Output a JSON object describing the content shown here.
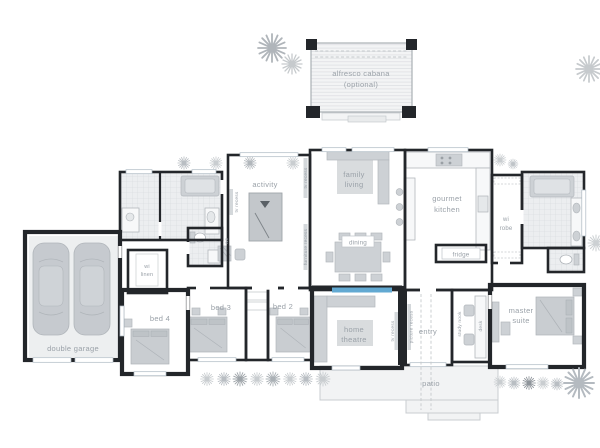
{
  "page": {
    "title": "house floor plan"
  },
  "colors": {
    "wall": "#23262a",
    "tile_floor": "#eceef0",
    "furniture_grey": "#cdd1d5",
    "rug_grey": "#d9dcde",
    "screen_blue": "#62a9d2",
    "label_text": "#9aa1a8",
    "patio_grey": "#f2f3f4",
    "tree_light": "#c6cacd",
    "tree_dark": "#a6abb0"
  },
  "rooms": {
    "alfresco": {
      "line1": "alfresco cabana",
      "line2": "(optional)"
    },
    "family": {
      "line1": "family",
      "line2": "living"
    },
    "kitchen": {
      "line1": "gourmet",
      "line2": "kitchen"
    },
    "dining": {
      "label": "dining"
    },
    "activity": {
      "label": "activity"
    },
    "wi_robe": {
      "line1": "wi",
      "line2": "robe"
    },
    "wi_linen": {
      "line1": "wi",
      "line2": "linen"
    },
    "home_theatre": {
      "line1": "home",
      "line2": "theatre"
    },
    "bed2": {
      "label": "bed 2"
    },
    "bed3": {
      "label": "bed 3"
    },
    "bed4": {
      "label": "bed 4"
    },
    "master": {
      "line1": "master",
      "line2": "suite"
    },
    "entry": {
      "label": "entry"
    },
    "patio": {
      "label": "patio"
    },
    "garage": {
      "label": "double garage"
    }
  },
  "annotations": {
    "fridge": "fridge",
    "wc": "wc",
    "desk": "desk",
    "study_nook": "study nook",
    "tv_recess": "tv recess",
    "furniture_recess": "furniture recess",
    "picture_recess": "picture recess"
  }
}
